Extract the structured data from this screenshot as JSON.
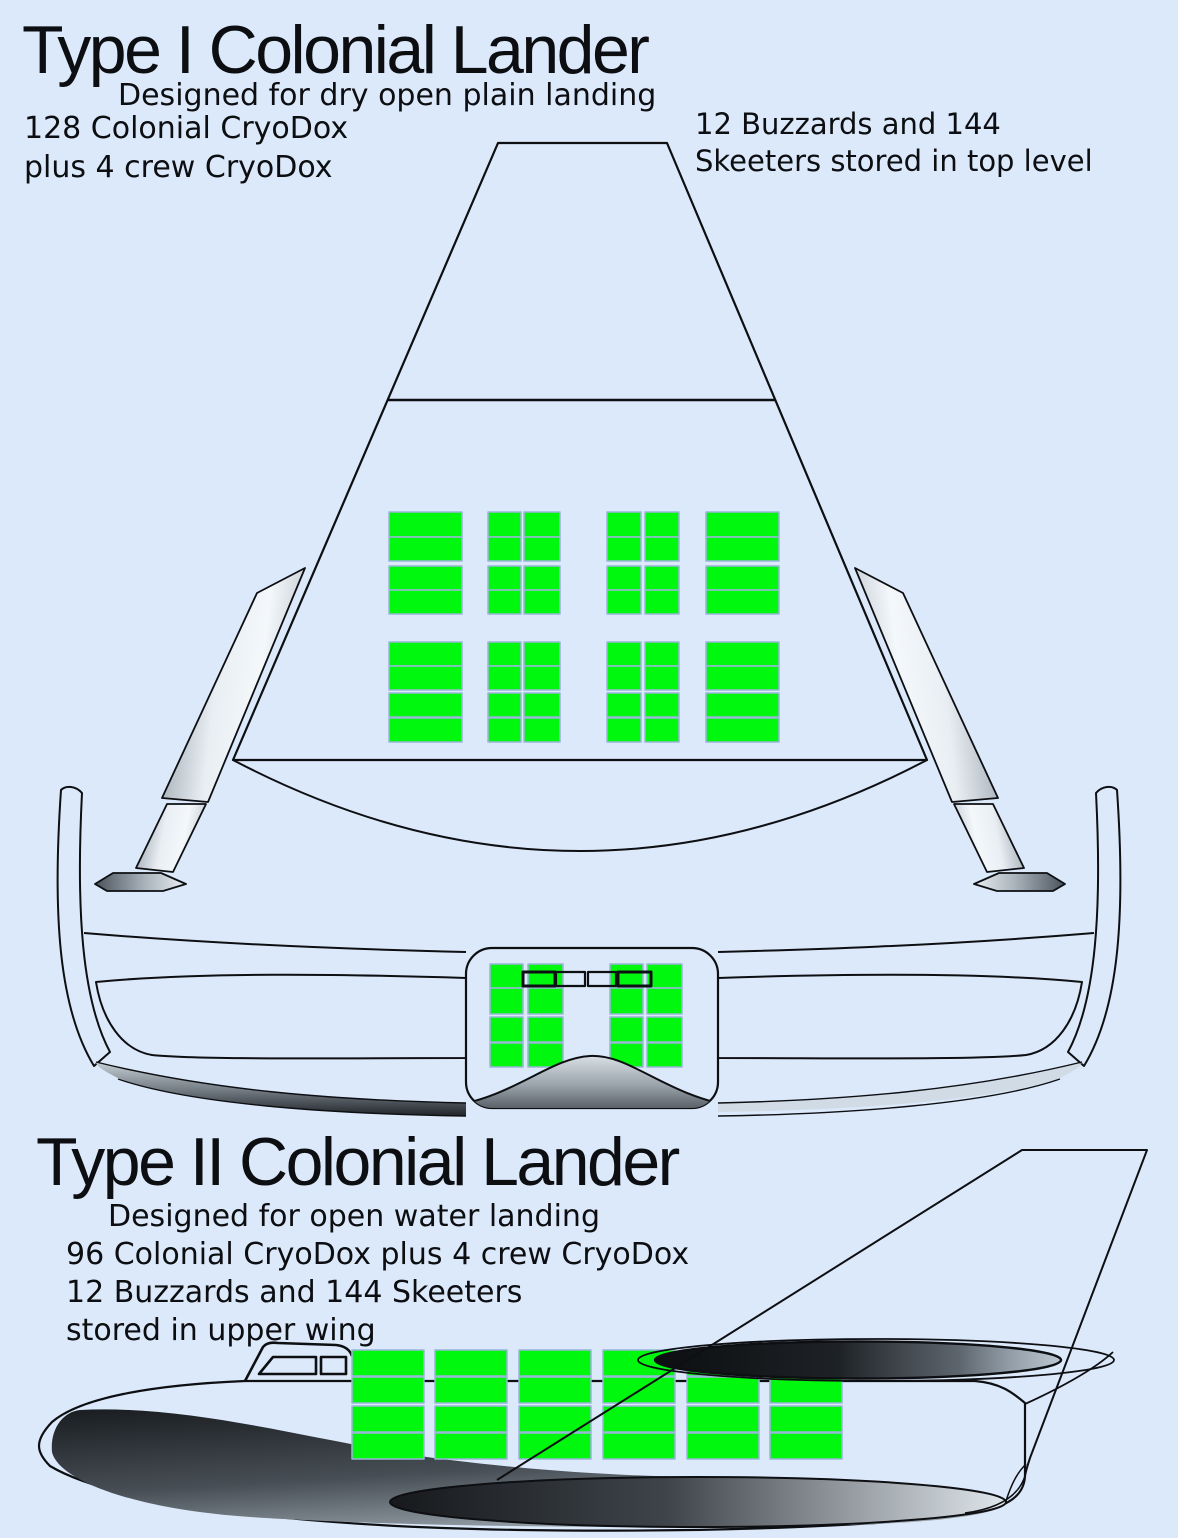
{
  "page": {
    "background": "#dce9fa",
    "line_color": "#0d0f12"
  },
  "colors": {
    "cargo_green": "#00f70e",
    "cargo_border": "#9ab6da",
    "metal_light": "#f2f6f9",
    "metal_dark": "#8c97a2",
    "shadow_dark": "#1a1e22"
  },
  "type1": {
    "title": "Type I Colonial Lander",
    "subtitle": "Designed for dry open plain landing",
    "note_left_line1": "128 Colonial CryoDox",
    "note_left_line2": "plus 4 crew CryoDox",
    "note_right_line1": "12 Buzzards and 144",
    "note_right_line2": "Skeeters stored in top level"
  },
  "type2": {
    "title": "Type II Colonial Lander",
    "line1": "Designed for open water landing",
    "line2": "96 Colonial CryoDox plus 4 crew CryoDox",
    "line3": "12 Buzzards and 144 Skeeters",
    "line4": "stored in upper wing"
  },
  "grids": [
    {
      "target": "t1-cone-cargo",
      "cols": [
        {
          "x": 389,
          "w": 73
        },
        {
          "x": 488,
          "w": 33
        },
        {
          "x": 524,
          "w": 36
        },
        {
          "x": 607,
          "w": 34
        },
        {
          "x": 645,
          "w": 34
        },
        {
          "x": 706,
          "w": 73
        }
      ],
      "rows": [
        {
          "y": 512,
          "h": 25
        },
        {
          "y": 537,
          "h": 24
        },
        {
          "y": 566,
          "h": 24
        },
        {
          "y": 590,
          "h": 24
        },
        {
          "y": 642,
          "h": 24
        },
        {
          "y": 666,
          "h": 24
        },
        {
          "y": 693,
          "h": 24
        },
        {
          "y": 718,
          "h": 24
        }
      ]
    },
    {
      "target": "t1-pod-cargo",
      "cols": [
        {
          "x": 490,
          "w": 33
        },
        {
          "x": 528,
          "w": 35
        },
        {
          "x": 610,
          "w": 33
        },
        {
          "x": 647,
          "w": 35
        }
      ],
      "rows": [
        {
          "y": 964,
          "h": 24
        },
        {
          "y": 988,
          "h": 26
        },
        {
          "y": 1017,
          "h": 25
        },
        {
          "y": 1043,
          "h": 24
        }
      ]
    },
    {
      "target": "t2-cargo",
      "cols": [
        {
          "x": 352,
          "w": 72
        },
        {
          "x": 435,
          "w": 72
        },
        {
          "x": 519,
          "w": 72
        },
        {
          "x": 603,
          "w": 72
        },
        {
          "x": 687,
          "w": 72
        },
        {
          "x": 770,
          "w": 72
        }
      ],
      "rows": [
        {
          "y": 1350,
          "h": 26
        },
        {
          "y": 1377,
          "h": 26
        },
        {
          "y": 1406,
          "h": 26
        },
        {
          "y": 1433,
          "h": 26
        }
      ]
    }
  ],
  "hatches": {
    "target": "t1-hatches",
    "y": 972,
    "h": 14,
    "items": [
      {
        "x": 523,
        "w": 32,
        "s": 3
      },
      {
        "x": 556,
        "w": 29,
        "s": 2.2
      },
      {
        "x": 588,
        "w": 28,
        "s": 2.2
      },
      {
        "x": 618,
        "w": 33,
        "s": 3
      }
    ]
  }
}
